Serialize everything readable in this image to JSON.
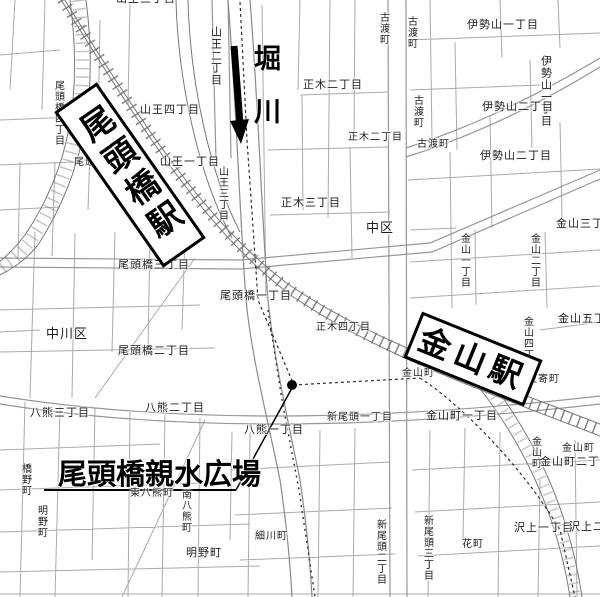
{
  "callouts": {
    "river": {
      "label": "堀川"
    },
    "otobashi_station": {
      "label": "尾頭橋駅"
    },
    "kanayama_station": {
      "label": "金山駅"
    },
    "plaza": {
      "label": "尾頭橋親水広場"
    }
  },
  "colors": {
    "ink": "#000000",
    "street_line": "#aaaaaa",
    "railway": "#6e6e6e",
    "background": "#ffffff"
  },
  "map_labels": [
    {
      "text": "山王三丁目",
      "x": 116,
      "y": -6,
      "fs": 11,
      "v": 0
    },
    {
      "text": "山王二丁目",
      "x": 209,
      "y": 26,
      "fs": 11,
      "v": 1
    },
    {
      "text": "尾頭橋四丁目",
      "x": 52,
      "y": 80,
      "fs": 10,
      "v": 1
    },
    {
      "text": "山王四丁目",
      "x": 140,
      "y": 105,
      "fs": 11,
      "v": 0
    },
    {
      "text": "尾頭橋四丁目",
      "x": 74,
      "y": 158,
      "fs": 10,
      "v": 0
    },
    {
      "text": "山王一丁目",
      "x": 160,
      "y": 157,
      "fs": 11,
      "v": 0
    },
    {
      "text": "山王三丁目",
      "x": 216,
      "y": 166,
      "fs": 10,
      "v": 1
    },
    {
      "text": "古渡町",
      "x": 377,
      "y": 12,
      "fs": 10,
      "v": 1
    },
    {
      "text": "古渡町",
      "x": 405,
      "y": 16,
      "fs": 10,
      "v": 1
    },
    {
      "text": "伊勢山一丁目",
      "x": 467,
      "y": 20,
      "fs": 11,
      "v": 0
    },
    {
      "text": "伊勢山一丁目",
      "x": 539,
      "y": 55,
      "fs": 11,
      "v": 1
    },
    {
      "text": "伊勢山二丁目",
      "x": 482,
      "y": 102,
      "fs": 11,
      "v": 0
    },
    {
      "text": "古渡町",
      "x": 411,
      "y": 95,
      "fs": 10,
      "v": 1
    },
    {
      "text": "古渡町",
      "x": 417,
      "y": 140,
      "fs": 10,
      "v": 0
    },
    {
      "text": "伊勢山二丁目",
      "x": 480,
      "y": 151,
      "fs": 11,
      "v": 0
    },
    {
      "text": "正木二丁目",
      "x": 303,
      "y": 80,
      "fs": 11,
      "v": 0
    },
    {
      "text": "正木二丁目",
      "x": 348,
      "y": 133,
      "fs": 10,
      "v": 0
    },
    {
      "text": "正木三丁目",
      "x": 281,
      "y": 198,
      "fs": 11,
      "v": 0
    },
    {
      "text": "中区",
      "x": 366,
      "y": 221,
      "fs": 13,
      "v": 0
    },
    {
      "text": "金山一丁目",
      "x": 458,
      "y": 233,
      "fs": 10,
      "v": 1
    },
    {
      "text": "金山二丁目",
      "x": 528,
      "y": 233,
      "fs": 10,
      "v": 1
    },
    {
      "text": "金山三丁目",
      "x": 556,
      "y": 219,
      "fs": 11,
      "v": 0
    },
    {
      "text": "尾頭橋三丁目",
      "x": 118,
      "y": 260,
      "fs": 11,
      "v": 0
    },
    {
      "text": "尾頭橋一丁目",
      "x": 220,
      "y": 291,
      "fs": 11,
      "v": 0
    },
    {
      "text": "中川区",
      "x": 46,
      "y": 327,
      "fs": 13,
      "v": 0
    },
    {
      "text": "尾頭橋二丁目",
      "x": 118,
      "y": 346,
      "fs": 11,
      "v": 0
    },
    {
      "text": "正木四丁目",
      "x": 316,
      "y": 323,
      "fs": 10,
      "v": 0
    },
    {
      "text": "金山五丁目",
      "x": 558,
      "y": 314,
      "fs": 11,
      "v": 0
    },
    {
      "text": "金山四丁目",
      "x": 521,
      "y": 316,
      "fs": 10,
      "v": 1
    },
    {
      "text": "八熊三丁目",
      "x": 30,
      "y": 408,
      "fs": 11,
      "v": 0
    },
    {
      "text": "八熊二丁目",
      "x": 145,
      "y": 403,
      "fs": 11,
      "v": 0
    },
    {
      "text": "八熊一丁目",
      "x": 244,
      "y": 425,
      "fs": 11,
      "v": 0
    },
    {
      "text": "金山町",
      "x": 402,
      "y": 369,
      "fs": 10,
      "v": 0
    },
    {
      "text": "波寄町",
      "x": 527,
      "y": 375,
      "fs": 10,
      "v": 0
    },
    {
      "text": "新尾頭一丁目",
      "x": 327,
      "y": 413,
      "fs": 10,
      "v": 0
    },
    {
      "text": "金山町一丁目",
      "x": 426,
      "y": 411,
      "fs": 11,
      "v": 0
    },
    {
      "text": "金山町",
      "x": 529,
      "y": 436,
      "fs": 10,
      "v": 1
    },
    {
      "text": "金山町",
      "x": 562,
      "y": 444,
      "fs": 10,
      "v": 0
    },
    {
      "text": "金山町二丁目",
      "x": 540,
      "y": 457,
      "fs": 11,
      "v": 0
    },
    {
      "text": "沢上一丁目",
      "x": 514,
      "y": 523,
      "fs": 11,
      "v": 0
    },
    {
      "text": "沢上二丁目",
      "x": 569,
      "y": 522,
      "fs": 11,
      "v": 0
    },
    {
      "text": "橋野町",
      "x": 19,
      "y": 463,
      "fs": 10,
      "v": 1
    },
    {
      "text": "南八熊町",
      "x": 179,
      "y": 489,
      "fs": 10,
      "v": 1
    },
    {
      "text": "東八熊町",
      "x": 130,
      "y": 489,
      "fs": 10,
      "v": 0
    },
    {
      "text": "明野町",
      "x": 35,
      "y": 505,
      "fs": 10,
      "v": 1
    },
    {
      "text": "明野町",
      "x": 186,
      "y": 548,
      "fs": 11,
      "v": 0
    },
    {
      "text": "細川町",
      "x": 255,
      "y": 532,
      "fs": 10,
      "v": 0
    },
    {
      "text": "新尾頭二丁目",
      "x": 374,
      "y": 519,
      "fs": 10,
      "v": 1
    },
    {
      "text": "新尾頭三丁目",
      "x": 421,
      "y": 515,
      "fs": 10,
      "v": 1
    },
    {
      "text": "花町",
      "x": 462,
      "y": 540,
      "fs": 10,
      "v": 0
    }
  ]
}
